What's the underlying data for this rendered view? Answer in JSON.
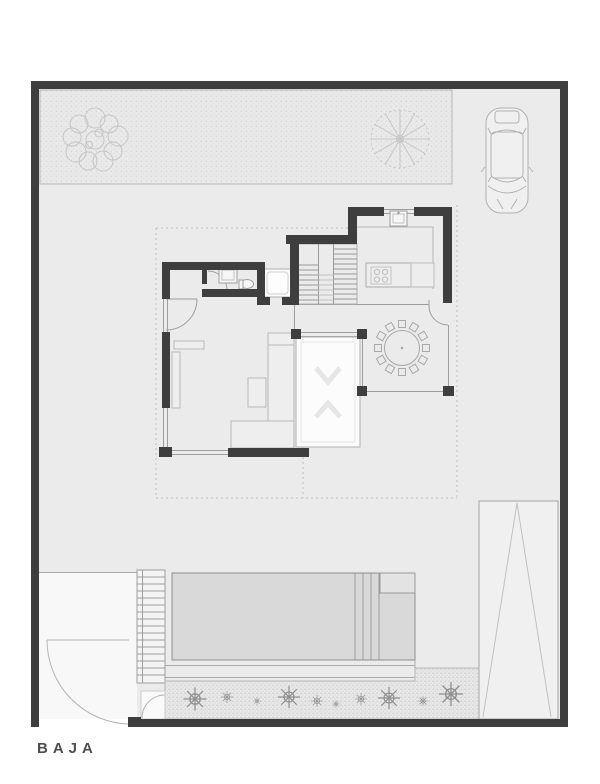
{
  "page": {
    "type": "architectural-floor-plan",
    "floor_label": "BAJA"
  },
  "colors": {
    "paper": "#ffffff",
    "site_fill": "#ebebeb",
    "wall": "#3e3e3e",
    "line": "#9e9e9e",
    "light_line": "#c4c4c4",
    "dotted_line": "#c2c2c2",
    "pool_water": "#d9d9d9",
    "void_white": "#fcfcfc",
    "terrace_white": "#f8f8f8",
    "label_text": "#4e4e4e"
  },
  "features": [
    "site-boundary-wall",
    "top-garden-bed",
    "deciduous-tree",
    "palm-tree",
    "car",
    "driveway",
    "kitchen",
    "kitchen-island",
    "cooktop",
    "kitchen-sink",
    "kitchen-window",
    "staircase",
    "elevator",
    "powder-room",
    "bathroom-sink",
    "toilet",
    "entry-door",
    "living-room",
    "sofa",
    "coffee-table",
    "console",
    "dining-table",
    "dining-chairs",
    "courtyard-void",
    "glass-wall",
    "roof-overhang-dotted-line",
    "rear-terrace",
    "outdoor-stairs",
    "swimming-pool",
    "pool-steps",
    "pool-deck",
    "planting-bed",
    "shrubs",
    "vehicle-ramp",
    "pedestrian-gate",
    "service-gate"
  ]
}
